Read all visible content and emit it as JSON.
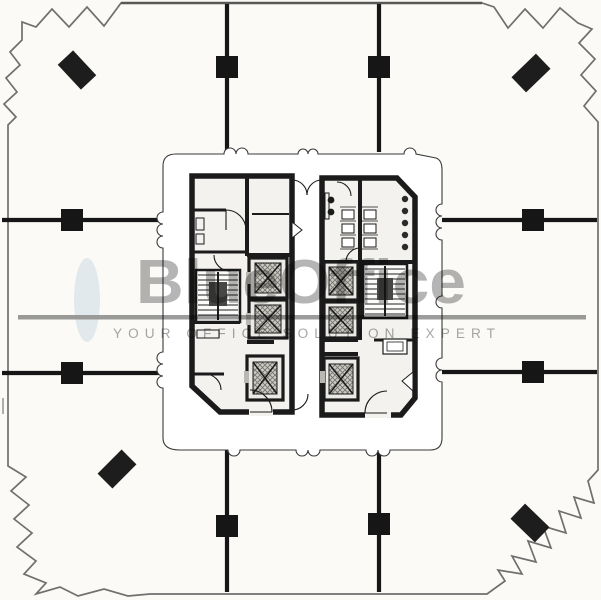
{
  "page": {
    "background_color": "#fbfaf7"
  },
  "watermark": {
    "brand": "BlueOffice",
    "tagline": "YOUR OFFICE SOLUTION EXPERT",
    "brand_color": "#b5b5b5",
    "tagline_color": "#a7a7a7",
    "divider_color": "#9c9c9c",
    "accent_ellipse_color": "#cfe0ec"
  },
  "plan": {
    "ink_color": "#1b1b1b",
    "outline_color": "#6f6f6f",
    "floor_color": "#f3f2ee",
    "square_column_count": 8,
    "corner_column_count": 4,
    "elevator_count": 6,
    "stairwell_count": 2,
    "restroom_count": 1
  }
}
